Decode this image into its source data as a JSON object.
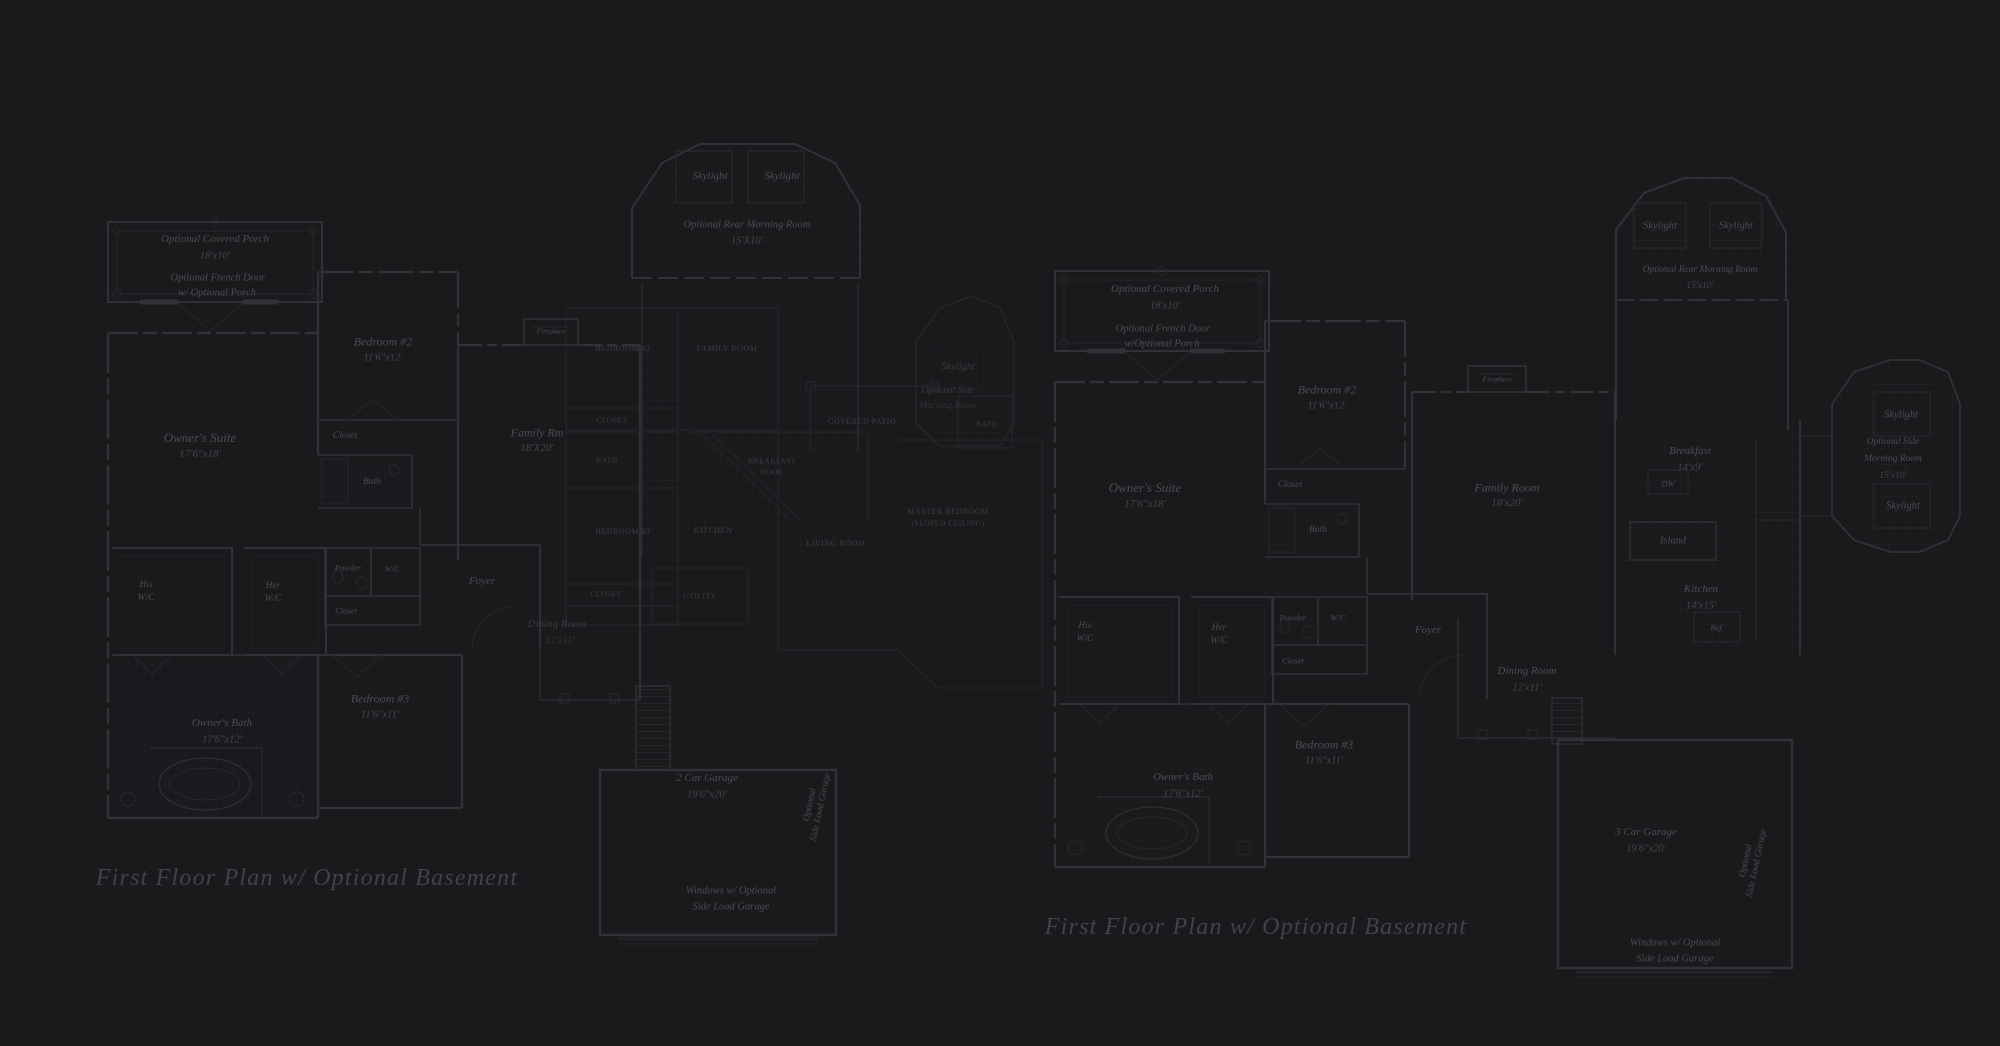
{
  "titles": {
    "left": "First Floor Plan  w/ Optional Basement",
    "right": "First Floor Plan  w/ Optional Basement"
  },
  "left": {
    "porch_name": "Optional Covered Porch",
    "porch_dims": "18'x10'",
    "french_door_1": "Optional French Door",
    "french_door_2": "w/ Optional Porch",
    "owners_suite_name": "Owner's Suite",
    "owners_suite_dims": "17'6\"x18'",
    "bedroom2_name": "Bedroom #2",
    "bedroom2_dims": "11'6\"x12'",
    "closet_bedroom2": "Closet",
    "bath_bedroom2": "Bath",
    "his_1": "His",
    "his_2": "W/C",
    "her_1": "Her",
    "her_2": "W/C",
    "powder": "Powder",
    "wc": "W/C",
    "closet_hall": "Closet",
    "owners_bath_name": "Owner's Bath",
    "owners_bath_dims": "17'6\"x12'",
    "bedroom3_name": "Bedroom #3",
    "bedroom3_dims": "11'6\"x11'",
    "family_name": "Family Rm",
    "family_dims": "18'X20'",
    "fireplace": "Fireplace",
    "foyer": "Foyer",
    "dining_name": "Dining Room",
    "dining_dims": "12'x11'",
    "skylight_rear_left": "Skylight",
    "skylight_rear_right": "Skylight",
    "morning_rear_name": "Optional Rear Morning Room",
    "morning_rear_dims": "15'X10'",
    "skylight_side": "Skylight",
    "morning_side_1": "Optional Side",
    "morning_side_2": "Morning Room",
    "garage_name": "2 Car Garage",
    "garage_dims": "19'6\"x20'",
    "windows_note_1": "Windows w/ Optional",
    "windows_note_2": "Side Load Garage",
    "side_load_1": "Optional",
    "side_load_2": "Side Load Garage"
  },
  "center": {
    "bedroom2": "BEDROOM #2",
    "family_room": "FAMILY ROOM",
    "breakfast_1": "BREAKFAST",
    "breakfast_2": "NOOK",
    "kitchen": "KITCHEN",
    "living_room": "LIVING ROOM",
    "utility": "UTILITY",
    "bath_1": "BATH",
    "closet_1": "CLOSET",
    "closet_2": "CLOSET",
    "bedroom3": "BEDROOM #3",
    "covered_patio": "COVERED PATIO",
    "master_1": "MASTER BEDROOM",
    "master_2": "(SLOPED CEILING)",
    "bath_2": "BATH"
  },
  "right": {
    "porch_name": "Optional Covered Porch",
    "porch_dims": "18'x10'",
    "french_door_1": "Optional French Door",
    "french_door_2": "w/Optional Porch",
    "owners_suite_name": "Owner's Suite",
    "owners_suite_dims": "17'6\"x18'",
    "bedroom2_name": "Bedroom #2",
    "bedroom2_dims": "11'6\"x12'",
    "closet_bedroom2": "Closet",
    "bath_bedroom2": "Bath",
    "his_1": "His",
    "his_2": "W/C",
    "her_1": "Her",
    "her_2": "W/C",
    "powder": "Powder",
    "wc": "W/C",
    "closet_hall": "Closet",
    "owners_bath_name": "Owner's Bath",
    "owners_bath_dims": "17'6\"x12'",
    "bedroom3_name": "Bedroom #3",
    "bedroom3_dims": "11'6\"x11'",
    "family_name": "Family Room",
    "family_dims": "18'x20'",
    "fireplace": "Fireplace",
    "foyer": "Foyer",
    "dining_name": "Dining Room",
    "dining_dims": "12'x11'",
    "breakfast_name": "Breakfast",
    "breakfast_dims": "14'x9'",
    "dw": "DW",
    "island": "Island",
    "kitchen_name": "Kitchen",
    "kitchen_dims": "14'x15'",
    "ref": "Ref.",
    "skylight_rear_left": "Skylight",
    "skylight_rear_right": "Skylight",
    "morning_rear_name": "Optional Rear Morning Room",
    "morning_rear_dims": "15'x10'",
    "skylight_side_top": "Skylight",
    "morning_side_1": "Optional Side",
    "morning_side_2": "Morning Room",
    "morning_side_dims": "15'x10'",
    "skylight_side_bottom": "Skylight",
    "garage_name": "3 Car Garage",
    "garage_dims": "19'6\"x20'",
    "windows_note_1": "Windows w/ Optional",
    "windows_note_2": "Side Load Garage",
    "side_load_1": "Optional",
    "side_load_2": "Side Load Garage"
  }
}
